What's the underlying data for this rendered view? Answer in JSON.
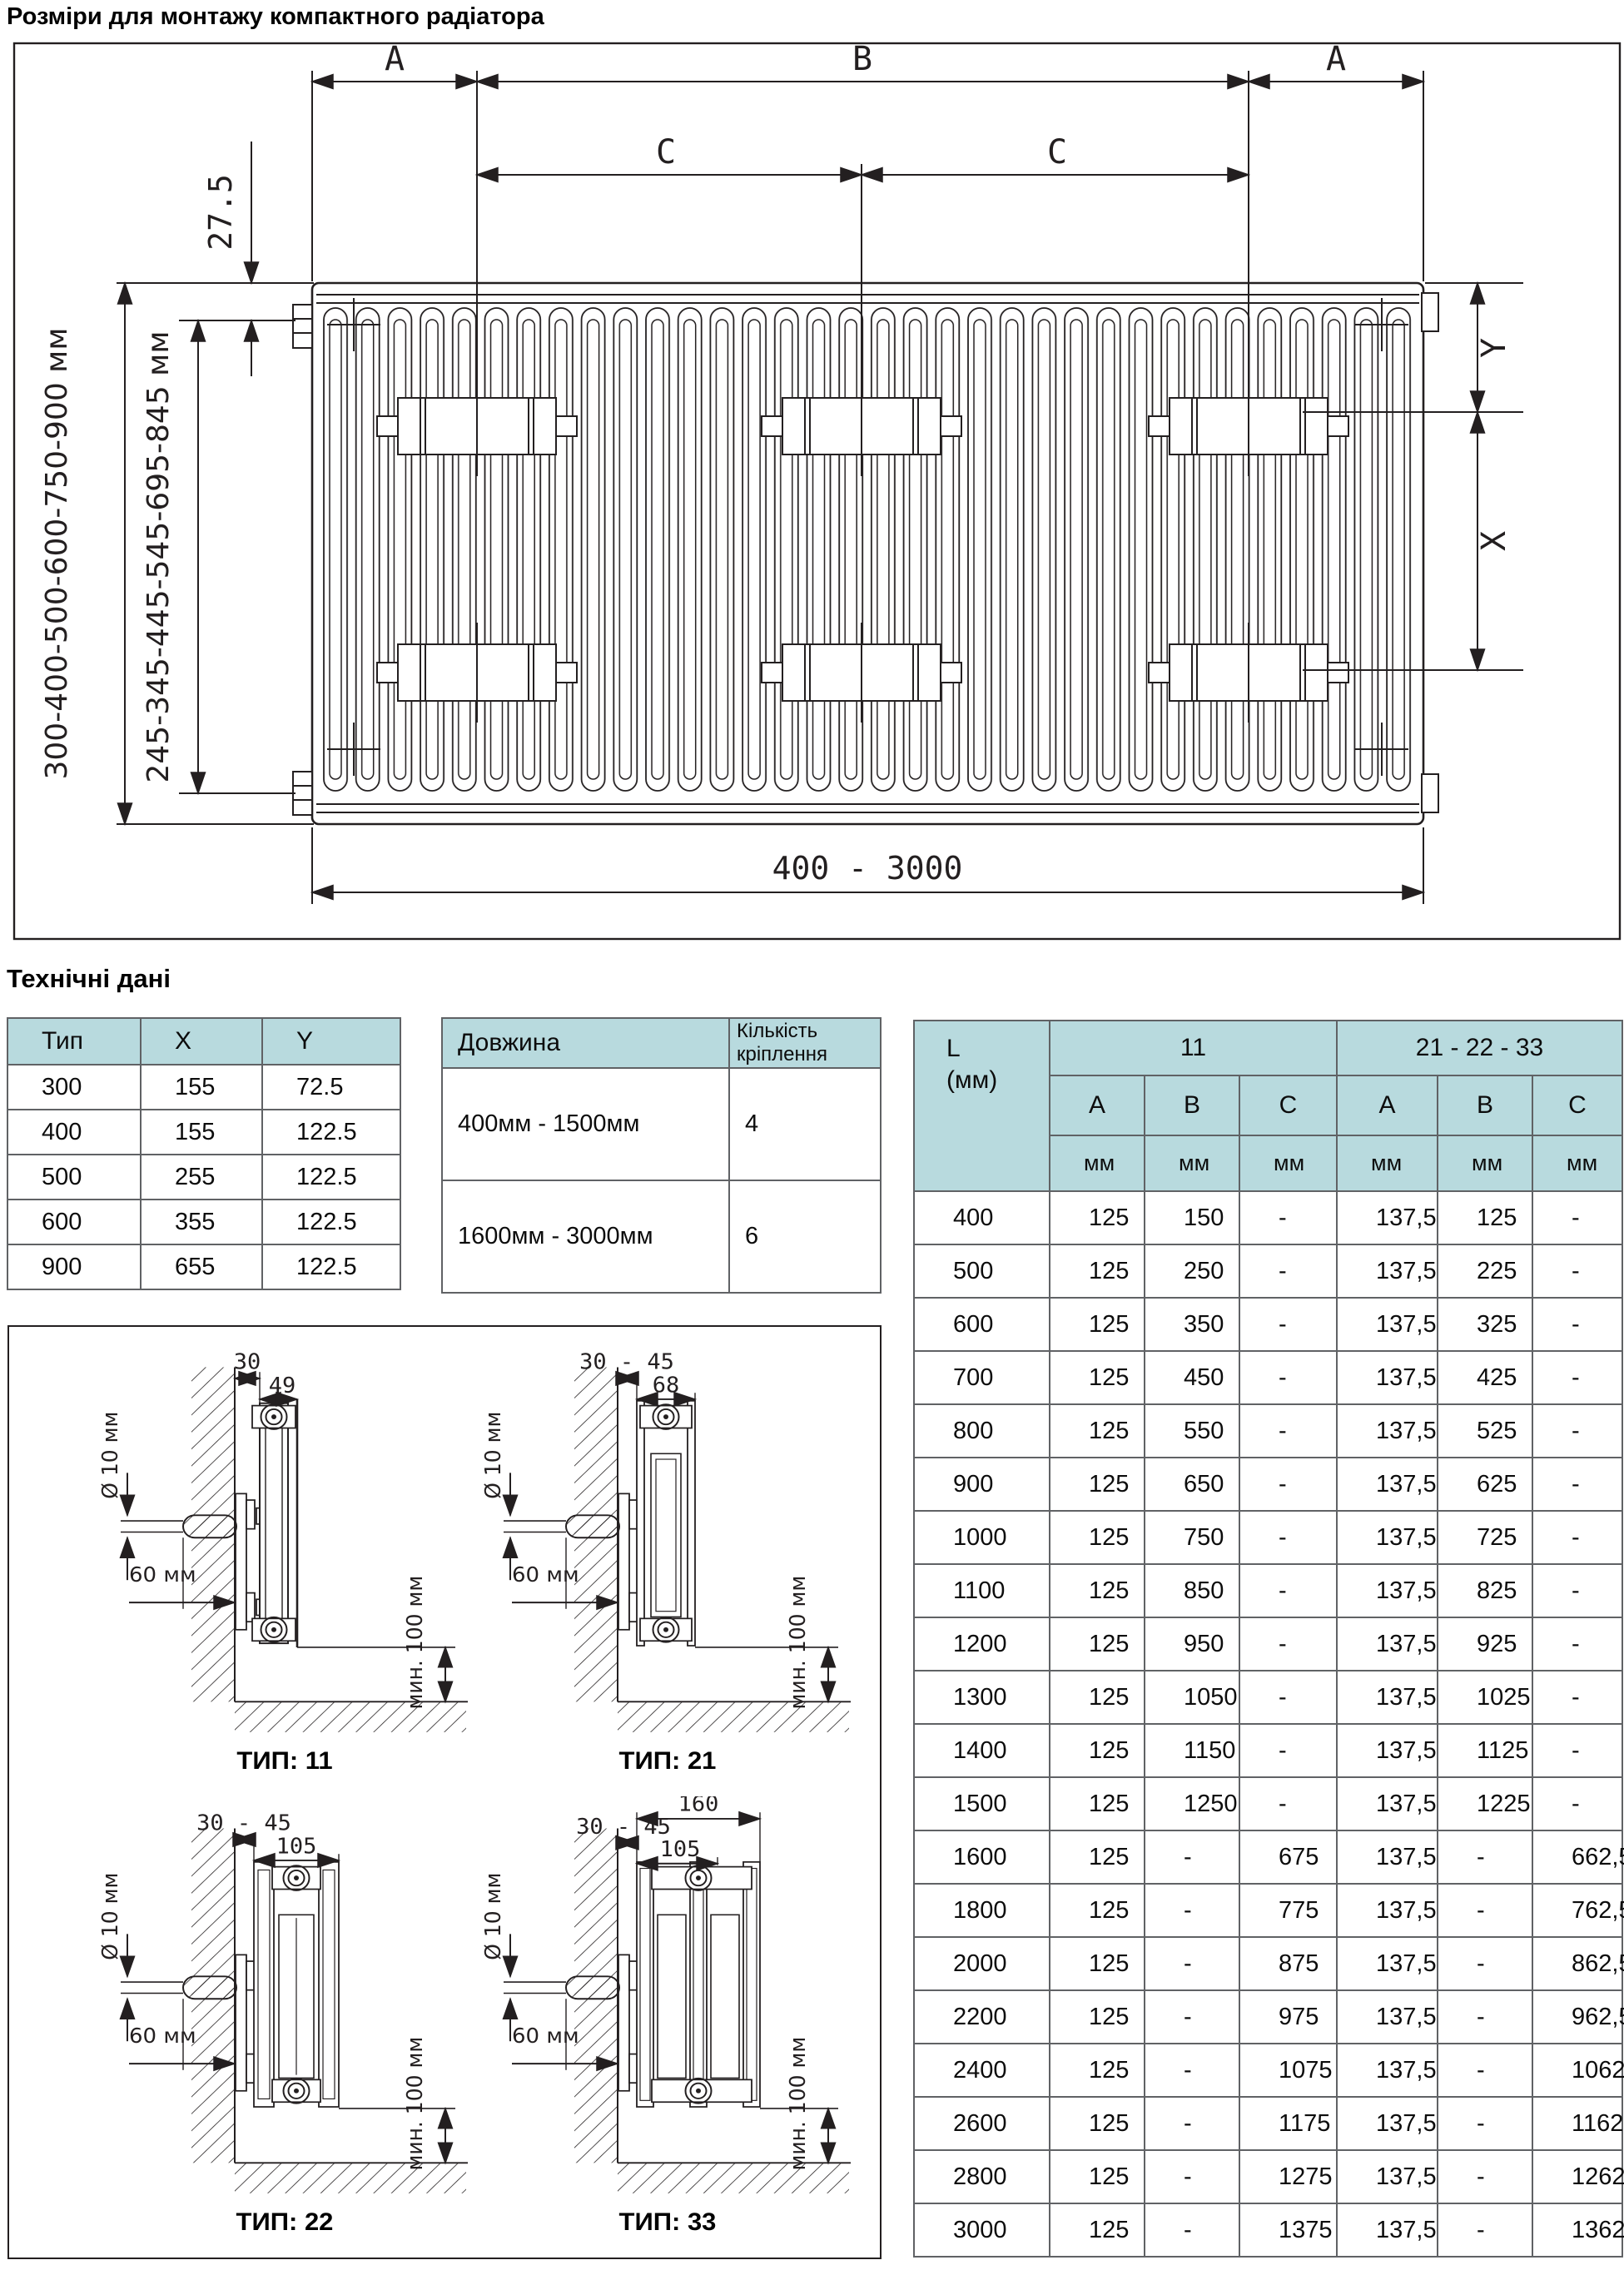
{
  "page": {
    "title": "Розміри для монтажу компактного радіатора",
    "section2_title": "Технічні дані"
  },
  "colors": {
    "header_bg": "#b8dade",
    "line": "#231f20",
    "table_border": "#606265"
  },
  "drawing": {
    "dims": {
      "a_left": "A",
      "b": "B",
      "a_right": "A",
      "c_left": "C",
      "c_right": "C",
      "offset_top": "27.5",
      "height_range": "300-400-500-600-750-900 мм",
      "mount_height_range": "245-345-445-545-695-845 мм",
      "length_range": "400 - 3000",
      "x": "X",
      "y": "Y"
    }
  },
  "type_table": {
    "headers": [
      "Тип",
      "X",
      "Y"
    ],
    "rows": [
      [
        "300",
        "155",
        "72.5"
      ],
      [
        "400",
        "155",
        "122.5"
      ],
      [
        "500",
        "255",
        "122.5"
      ],
      [
        "600",
        "355",
        "122.5"
      ],
      [
        "900",
        "655",
        "122.5"
      ]
    ]
  },
  "fasteners_table": {
    "headers": [
      "Довжина",
      "Кількість кріплення"
    ],
    "rows": [
      [
        "400мм - 1500мм",
        "4"
      ],
      [
        "1600мм - 3000мм",
        "6"
      ]
    ]
  },
  "dimensions_table": {
    "col0_header_line1": "L",
    "col0_header_line2": "(мм)",
    "group_headers": [
      "11",
      "21 - 22 - 33"
    ],
    "sub_headers": [
      "A",
      "B",
      "C",
      "A",
      "B",
      "C"
    ],
    "unit_row": [
      "мм",
      "мм",
      "мм",
      "мм",
      "мм",
      "мм"
    ],
    "rows": [
      [
        "400",
        "125",
        "150",
        "-",
        "137,5",
        "125",
        "-"
      ],
      [
        "500",
        "125",
        "250",
        "-",
        "137,5",
        "225",
        "-"
      ],
      [
        "600",
        "125",
        "350",
        "-",
        "137,5",
        "325",
        "-"
      ],
      [
        "700",
        "125",
        "450",
        "-",
        "137,5",
        "425",
        "-"
      ],
      [
        "800",
        "125",
        "550",
        "-",
        "137,5",
        "525",
        "-"
      ],
      [
        "900",
        "125",
        "650",
        "-",
        "137,5",
        "625",
        "-"
      ],
      [
        "1000",
        "125",
        "750",
        "-",
        "137,5",
        "725",
        "-"
      ],
      [
        "1100",
        "125",
        "850",
        "-",
        "137,5",
        "825",
        "-"
      ],
      [
        "1200",
        "125",
        "950",
        "-",
        "137,5",
        "925",
        "-"
      ],
      [
        "1300",
        "125",
        "1050",
        "-",
        "137,5",
        "1025",
        "-"
      ],
      [
        "1400",
        "125",
        "1150",
        "-",
        "137,5",
        "1125",
        "-"
      ],
      [
        "1500",
        "125",
        "1250",
        "-",
        "137,5",
        "1225",
        "-"
      ],
      [
        "1600",
        "125",
        "-",
        "675",
        "137,5",
        "-",
        "662,5"
      ],
      [
        "1800",
        "125",
        "-",
        "775",
        "137,5",
        "-",
        "762,5"
      ],
      [
        "2000",
        "125",
        "-",
        "875",
        "137,5",
        "-",
        "862,5"
      ],
      [
        "2200",
        "125",
        "-",
        "975",
        "137,5",
        "-",
        "962,5"
      ],
      [
        "2400",
        "125",
        "-",
        "1075",
        "137,5",
        "-",
        "1062,5"
      ],
      [
        "2600",
        "125",
        "-",
        "1175",
        "137,5",
        "-",
        "1162,5"
      ],
      [
        "2800",
        "125",
        "-",
        "1275",
        "137,5",
        "-",
        "1262,5"
      ],
      [
        "3000",
        "125",
        "-",
        "1375",
        "137,5",
        "-",
        "1362,5"
      ]
    ]
  },
  "mount_diagrams": {
    "common": {
      "hole_dia": "Ø 10 мм",
      "depth": "60 мм",
      "floor_clearance": "мин. 100 мм"
    },
    "items": [
      {
        "caption": "ТИП: 11",
        "wall_gap": "30",
        "depth_dim": "49"
      },
      {
        "caption": "ТИП: 21",
        "wall_gap": "30 - 45",
        "depth_dim": "68"
      },
      {
        "caption": "ТИП: 22",
        "wall_gap": "30 - 45",
        "depth_dim": "105"
      },
      {
        "caption": "ТИП: 33",
        "wall_gap": "30 - 45",
        "depth_dim": "105",
        "total_depth": "160"
      }
    ]
  }
}
